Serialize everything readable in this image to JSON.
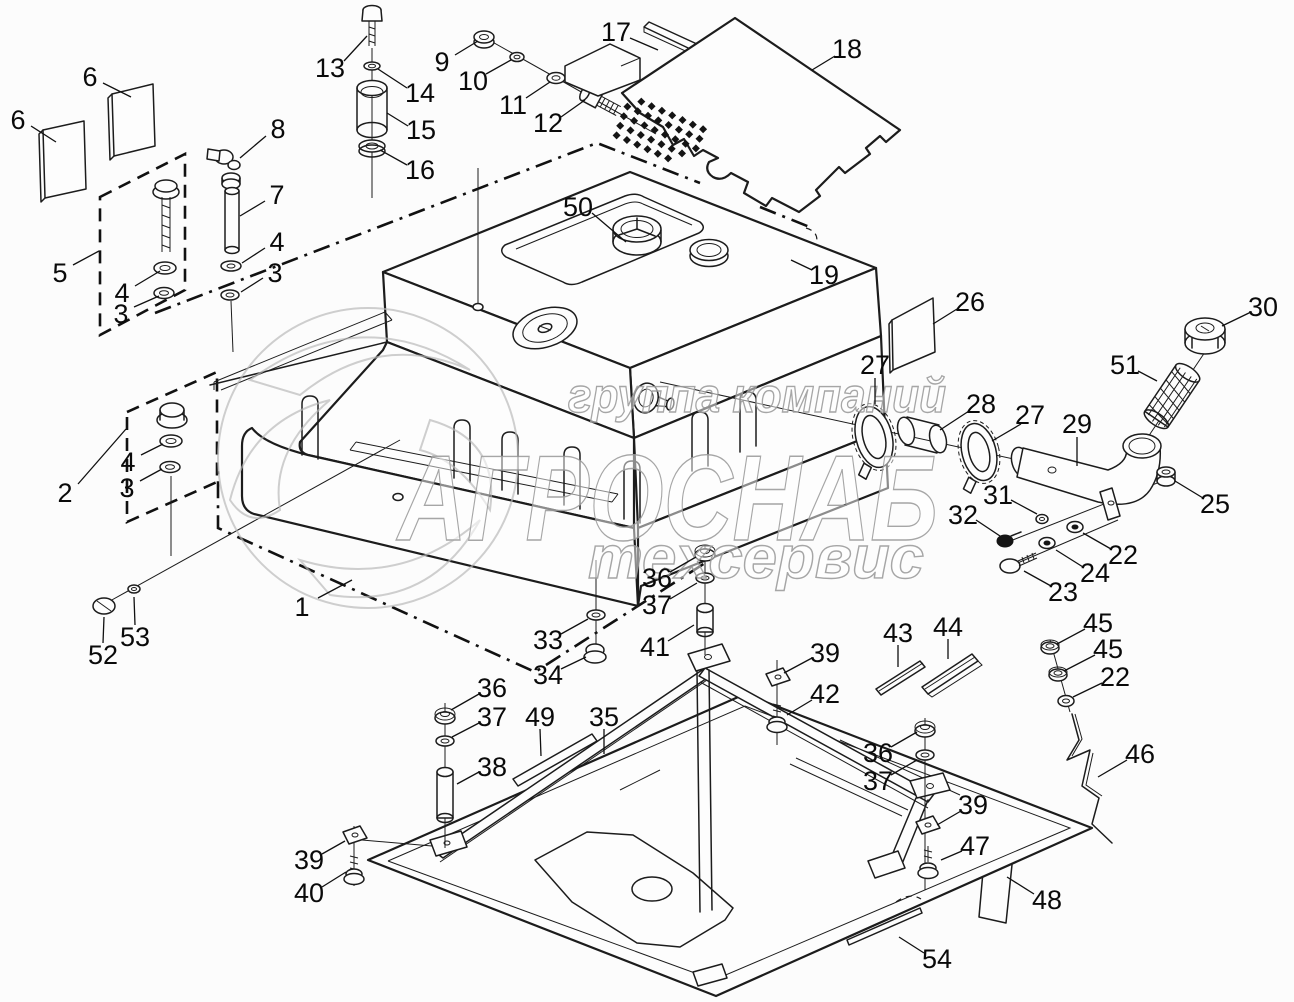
{
  "page": {
    "type": "exploded-parts-diagram",
    "subject": "fuel-tank-assembly",
    "background_color": "#fcfcfc",
    "line_color": "#1c1c1c"
  },
  "watermark": {
    "line1": "группа компаний",
    "line2": "АГРОСНАБ",
    "line3": "техсервис",
    "stroke_color": "#9d9d9d"
  },
  "perforation": {
    "rows": 5,
    "cols": 8,
    "origin": [
      631,
      97
    ],
    "col_step": [
      10.3,
      4.6
    ],
    "row_step": [
      -3.6,
      9.6
    ],
    "size": 4.0,
    "skip": [
      [
        0,
        0
      ],
      [
        3,
        7
      ],
      [
        4,
        6
      ],
      [
        4,
        7
      ]
    ]
  },
  "callouts": [
    {
      "n": "6",
      "x": 90,
      "y": 77,
      "leader": [
        [
          103,
          83
        ],
        [
          131,
          97
        ]
      ]
    },
    {
      "n": "6",
      "x": 18,
      "y": 120,
      "leader": [
        [
          31,
          126
        ],
        [
          56,
          142
        ]
      ]
    },
    {
      "n": "5",
      "x": 60,
      "y": 273,
      "leader": [
        [
          73,
          265
        ],
        [
          99,
          251
        ]
      ]
    },
    {
      "n": "4",
      "x": 122,
      "y": 293,
      "leader": [
        [
          135,
          286
        ],
        [
          160,
          271
        ]
      ]
    },
    {
      "n": "3",
      "x": 121,
      "y": 314,
      "leader": [
        [
          134,
          307
        ],
        [
          159,
          296
        ]
      ]
    },
    {
      "n": "8",
      "x": 278,
      "y": 129,
      "leader": [
        [
          266,
          136
        ],
        [
          240,
          158
        ]
      ]
    },
    {
      "n": "7",
      "x": 277,
      "y": 195,
      "leader": [
        [
          265,
          201
        ],
        [
          240,
          216
        ]
      ]
    },
    {
      "n": "4",
      "x": 277,
      "y": 242,
      "leader": [
        [
          265,
          248
        ],
        [
          242,
          263
        ]
      ]
    },
    {
      "n": "3",
      "x": 275,
      "y": 273,
      "leader": [
        [
          263,
          278
        ],
        [
          241,
          292
        ]
      ]
    },
    {
      "n": "13",
      "x": 330,
      "y": 68,
      "leader": [
        [
          344,
          61
        ],
        [
          367,
          36
        ]
      ]
    },
    {
      "n": "14",
      "x": 420,
      "y": 93,
      "leader": [
        [
          407,
          88
        ],
        [
          378,
          69
        ]
      ]
    },
    {
      "n": "15",
      "x": 421,
      "y": 130,
      "leader": [
        [
          408,
          126
        ],
        [
          387,
          113
        ]
      ]
    },
    {
      "n": "16",
      "x": 420,
      "y": 170,
      "leader": [
        [
          407,
          165
        ],
        [
          380,
          150
        ]
      ]
    },
    {
      "n": "9",
      "x": 442,
      "y": 62,
      "leader": [
        [
          455,
          55
        ],
        [
          478,
          41
        ]
      ]
    },
    {
      "n": "10",
      "x": 473,
      "y": 81,
      "leader": [
        [
          486,
          74
        ],
        [
          511,
          60
        ]
      ]
    },
    {
      "n": "11",
      "x": 513,
      "y": 105,
      "leader": [
        [
          526,
          98
        ],
        [
          550,
          82
        ]
      ]
    },
    {
      "n": "12",
      "x": 548,
      "y": 123,
      "leader": [
        [
          561,
          117
        ],
        [
          585,
          100
        ]
      ]
    },
    {
      "n": "17",
      "x": 616,
      "y": 32,
      "leader": [
        [
          630,
          38
        ],
        [
          658,
          50
        ]
      ]
    },
    {
      "n": "18",
      "x": 847,
      "y": 49,
      "leader": [
        [
          835,
          56
        ],
        [
          812,
          70
        ]
      ]
    },
    {
      "n": "19",
      "x": 824,
      "y": 275,
      "leader": [
        [
          812,
          270
        ],
        [
          791,
          260
        ]
      ]
    },
    {
      "n": "50",
      "x": 578,
      "y": 207,
      "leader": [
        [
          592,
          213
        ],
        [
          626,
          242
        ]
      ]
    },
    {
      "n": "26",
      "x": 970,
      "y": 302,
      "leader": [
        [
          957,
          309
        ],
        [
          933,
          324
        ]
      ]
    },
    {
      "n": "27",
      "x": 875,
      "y": 365,
      "leader": [
        [
          875,
          378
        ],
        [
          875,
          404
        ]
      ]
    },
    {
      "n": "28",
      "x": 981,
      "y": 404,
      "leader": [
        [
          969,
          411
        ],
        [
          940,
          430
        ]
      ]
    },
    {
      "n": "27",
      "x": 1030,
      "y": 415,
      "leader": [
        [
          1021,
          424
        ],
        [
          992,
          441
        ]
      ]
    },
    {
      "n": "29",
      "x": 1077,
      "y": 424,
      "leader": [
        [
          1077,
          437
        ],
        [
          1077,
          466
        ]
      ]
    },
    {
      "n": "30",
      "x": 1263,
      "y": 307,
      "leader": [
        [
          1251,
          312
        ],
        [
          1222,
          326
        ]
      ]
    },
    {
      "n": "51",
      "x": 1125,
      "y": 365,
      "leader": [
        [
          1138,
          371
        ],
        [
          1157,
          381
        ]
      ]
    },
    {
      "n": "25",
      "x": 1215,
      "y": 504,
      "leader": [
        [
          1203,
          498
        ],
        [
          1175,
          481
        ]
      ]
    },
    {
      "n": "31",
      "x": 998,
      "y": 495,
      "leader": [
        [
          1011,
          500
        ],
        [
          1037,
          514
        ]
      ]
    },
    {
      "n": "32",
      "x": 963,
      "y": 515,
      "leader": [
        [
          976,
          520
        ],
        [
          1000,
          536
        ]
      ]
    },
    {
      "n": "22",
      "x": 1123,
      "y": 555,
      "leader": [
        [
          1111,
          549
        ],
        [
          1083,
          533
        ]
      ]
    },
    {
      "n": "24",
      "x": 1095,
      "y": 573,
      "leader": [
        [
          1083,
          567
        ],
        [
          1056,
          550
        ]
      ]
    },
    {
      "n": "23",
      "x": 1063,
      "y": 592,
      "leader": [
        [
          1051,
          586
        ],
        [
          1024,
          571
        ]
      ]
    },
    {
      "n": "2",
      "x": 65,
      "y": 493,
      "leader": [
        [
          78,
          484
        ],
        [
          126,
          429
        ]
      ]
    },
    {
      "n": "4",
      "x": 128,
      "y": 462,
      "leader": [
        [
          141,
          455
        ],
        [
          163,
          444
        ]
      ]
    },
    {
      "n": "3",
      "x": 127,
      "y": 488,
      "leader": [
        [
          140,
          481
        ],
        [
          162,
          469
        ]
      ]
    },
    {
      "n": "53",
      "x": 135,
      "y": 637,
      "leader": [
        [
          135,
          625
        ],
        [
          134,
          597
        ]
      ]
    },
    {
      "n": "52",
      "x": 103,
      "y": 655,
      "leader": [
        [
          103,
          643
        ],
        [
          104,
          617
        ]
      ]
    },
    {
      "n": "1",
      "x": 302,
      "y": 607,
      "leader": [
        [
          318,
          598
        ],
        [
          352,
          580
        ]
      ]
    },
    {
      "n": "33",
      "x": 548,
      "y": 640,
      "leader": [
        [
          561,
          634
        ],
        [
          588,
          619
        ]
      ]
    },
    {
      "n": "34",
      "x": 548,
      "y": 675,
      "leader": [
        [
          561,
          669
        ],
        [
          586,
          657
        ]
      ]
    },
    {
      "n": "36",
      "x": 657,
      "y": 578,
      "leader": [
        [
          670,
          572
        ],
        [
          696,
          557
        ]
      ]
    },
    {
      "n": "37",
      "x": 657,
      "y": 605,
      "leader": [
        [
          670,
          599
        ],
        [
          697,
          583
        ]
      ]
    },
    {
      "n": "41",
      "x": 655,
      "y": 647,
      "leader": [
        [
          668,
          641
        ],
        [
          694,
          625
        ]
      ]
    },
    {
      "n": "39",
      "x": 825,
      "y": 653,
      "leader": [
        [
          812,
          658
        ],
        [
          784,
          673
        ]
      ]
    },
    {
      "n": "42",
      "x": 825,
      "y": 694,
      "leader": [
        [
          812,
          700
        ],
        [
          787,
          715
        ]
      ]
    },
    {
      "n": "43",
      "x": 898,
      "y": 633,
      "leader": [
        [
          898,
          645
        ],
        [
          898,
          667
        ]
      ]
    },
    {
      "n": "44",
      "x": 948,
      "y": 627,
      "leader": [
        [
          948,
          639
        ],
        [
          948,
          659
        ]
      ]
    },
    {
      "n": "45",
      "x": 1098,
      "y": 623,
      "leader": [
        [
          1085,
          629
        ],
        [
          1057,
          644
        ]
      ]
    },
    {
      "n": "45",
      "x": 1108,
      "y": 649,
      "leader": [
        [
          1095,
          655
        ],
        [
          1064,
          671
        ]
      ]
    },
    {
      "n": "22",
      "x": 1115,
      "y": 677,
      "leader": [
        [
          1102,
          683
        ],
        [
          1073,
          697
        ]
      ]
    },
    {
      "n": "46",
      "x": 1140,
      "y": 754,
      "leader": [
        [
          1127,
          760
        ],
        [
          1098,
          777
        ]
      ]
    },
    {
      "n": "36",
      "x": 492,
      "y": 688,
      "leader": [
        [
          479,
          694
        ],
        [
          451,
          710
        ]
      ]
    },
    {
      "n": "37",
      "x": 492,
      "y": 717,
      "leader": [
        [
          479,
          723
        ],
        [
          452,
          737
        ]
      ]
    },
    {
      "n": "38",
      "x": 492,
      "y": 767,
      "leader": [
        [
          479,
          772
        ],
        [
          457,
          784
        ]
      ]
    },
    {
      "n": "49",
      "x": 540,
      "y": 717,
      "leader": [
        [
          540,
          729
        ],
        [
          541,
          756
        ]
      ]
    },
    {
      "n": "35",
      "x": 604,
      "y": 717,
      "leader": [
        [
          604,
          729
        ],
        [
          604,
          754
        ]
      ]
    },
    {
      "n": "36",
      "x": 878,
      "y": 753,
      "leader": [
        [
          891,
          747
        ],
        [
          917,
          732
        ]
      ]
    },
    {
      "n": "37",
      "x": 878,
      "y": 781,
      "leader": [
        [
          891,
          775
        ],
        [
          917,
          760
        ]
      ]
    },
    {
      "n": "39",
      "x": 973,
      "y": 805,
      "leader": [
        [
          961,
          811
        ],
        [
          937,
          825
        ]
      ]
    },
    {
      "n": "47",
      "x": 975,
      "y": 846,
      "leader": [
        [
          962,
          851
        ],
        [
          941,
          860
        ]
      ]
    },
    {
      "n": "48",
      "x": 1047,
      "y": 900,
      "leader": [
        [
          1034,
          894
        ],
        [
          1007,
          877
        ]
      ]
    },
    {
      "n": "39",
      "x": 309,
      "y": 860,
      "leader": [
        [
          322,
          854
        ],
        [
          345,
          841
        ]
      ]
    },
    {
      "n": "40",
      "x": 309,
      "y": 893,
      "leader": [
        [
          322,
          887
        ],
        [
          346,
          872
        ]
      ]
    },
    {
      "n": "54",
      "x": 937,
      "y": 959,
      "leader": [
        [
          924,
          953
        ],
        [
          899,
          937
        ]
      ]
    }
  ]
}
